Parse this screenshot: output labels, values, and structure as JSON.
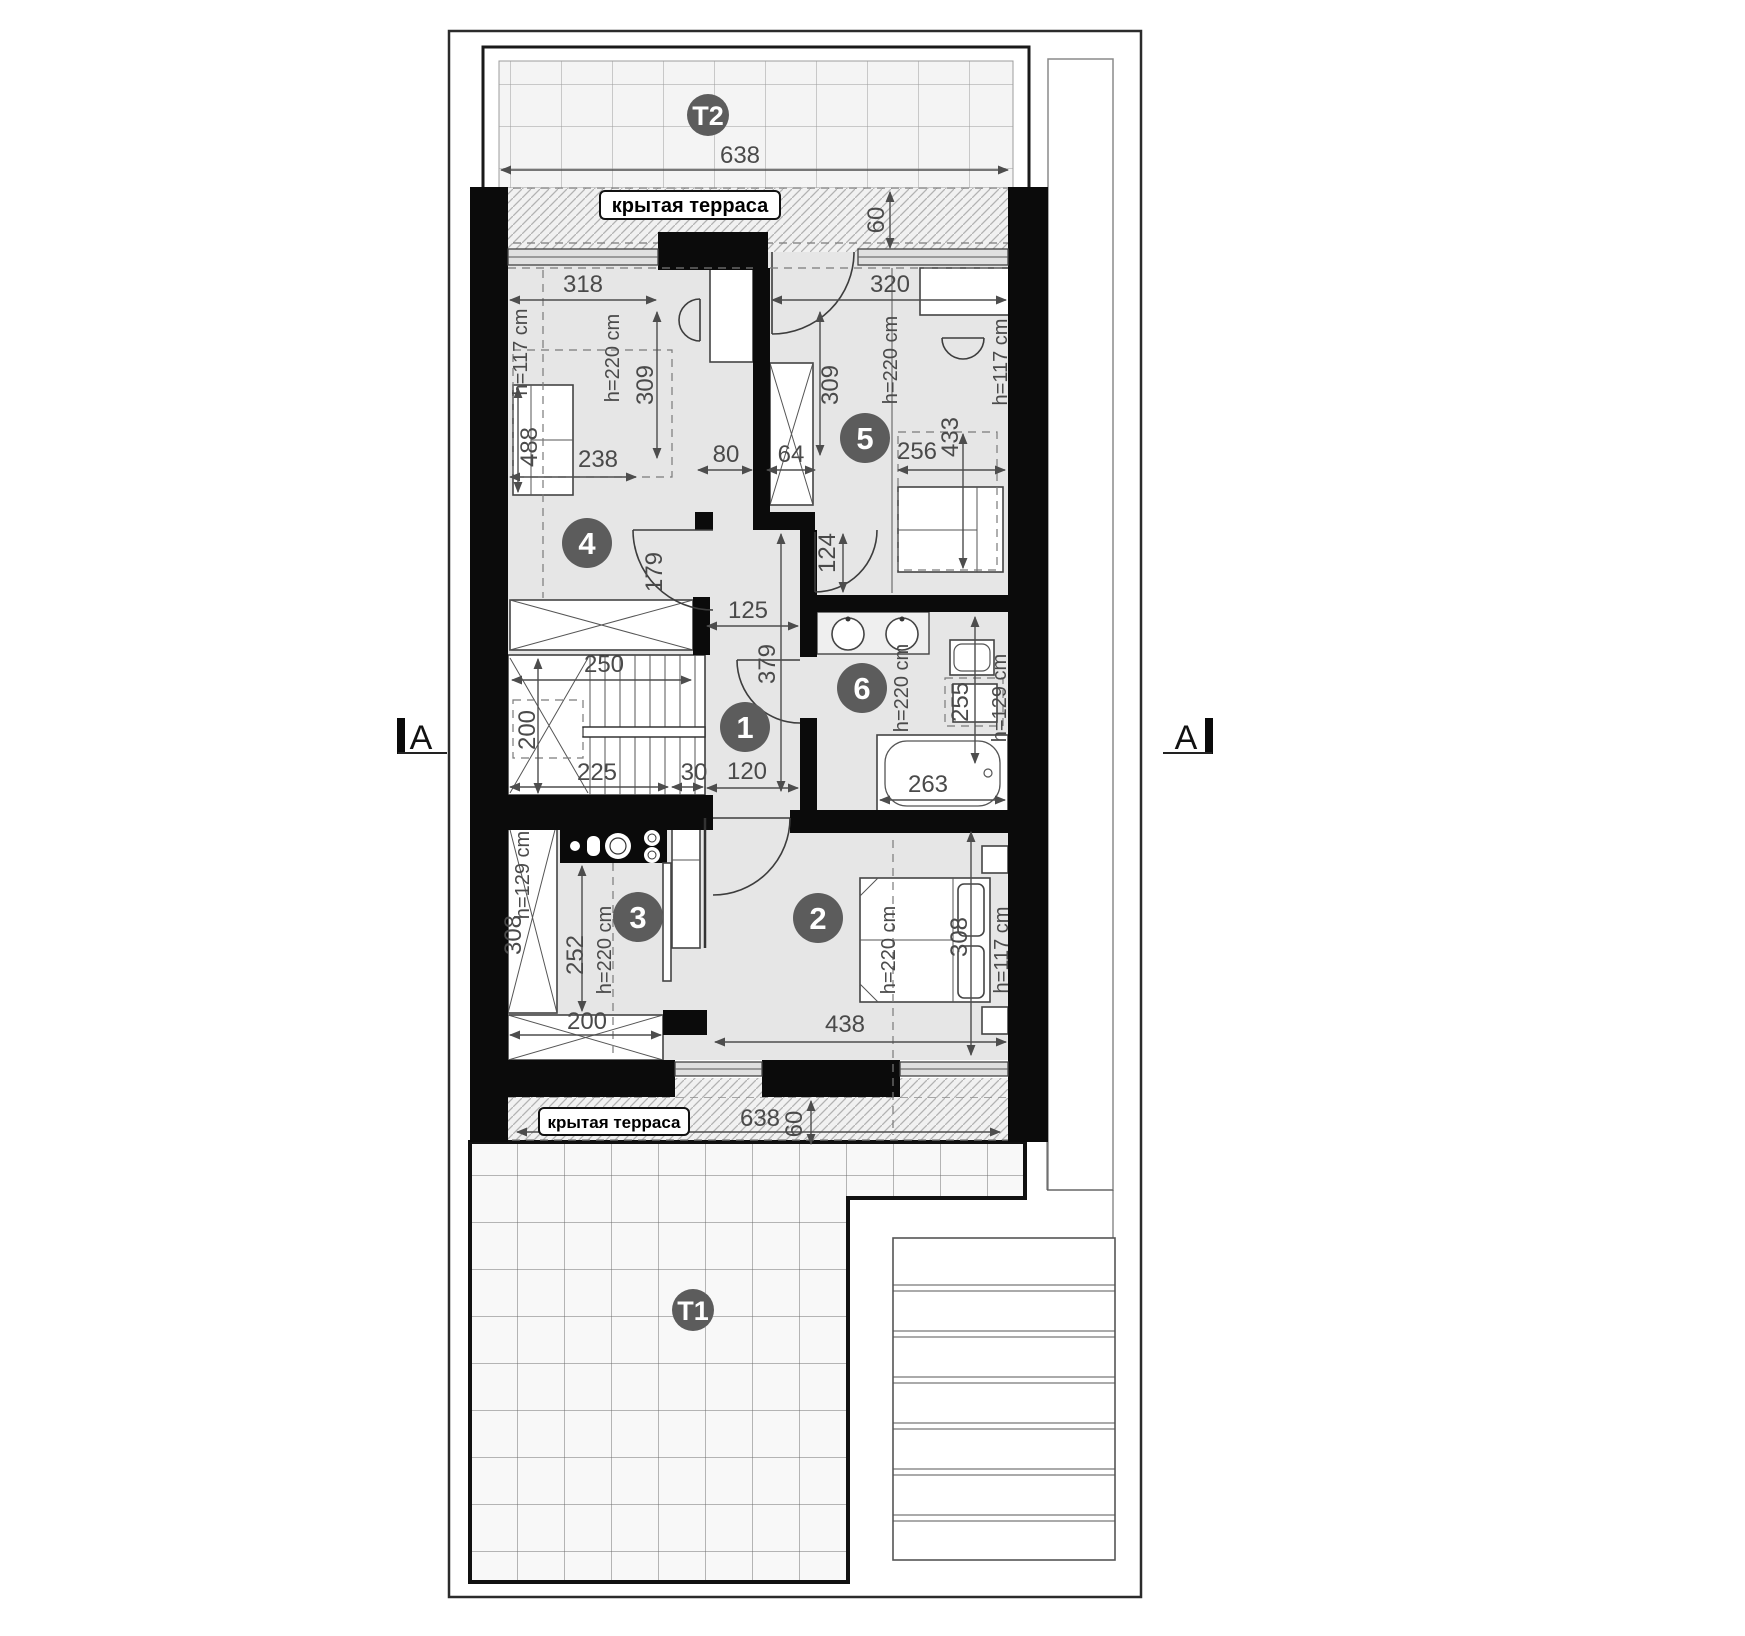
{
  "section": {
    "left": "A",
    "right": "A"
  },
  "terrace_top": {
    "badge": "T2",
    "label": "крытая терраса",
    "width": "638",
    "depth": "60"
  },
  "terrace_bottom": {
    "badge": "T1",
    "label": "крытая терраса",
    "width": "638",
    "depth": "60"
  },
  "rooms": {
    "r1": {
      "number": "1",
      "dim_width_top": "125",
      "dim_depth": "379",
      "dim_width_bottom": "120"
    },
    "r2": {
      "number": "2",
      "dim_width": "438",
      "dim_length": "308",
      "note_h220": "h=220 cm",
      "note_h117": "h=117 cm"
    },
    "r3": {
      "number": "3",
      "dim_width": "200",
      "dim_depth": "252",
      "dim_cabinet": "308",
      "note_h220": "h=220 cm",
      "note_h129": "h=129 cm"
    },
    "r4": {
      "number": "4",
      "dim_width_top": "318",
      "dim_depth": "309",
      "dim_sofa": "488",
      "dim_zone": "238",
      "dim_door": "179",
      "dim_niche": "80",
      "dim_shaft": "64",
      "note_h220": "h=220 cm",
      "note_h117": "h=117 cm"
    },
    "r5": {
      "number": "5",
      "dim_width_top": "320",
      "dim_depth": "309",
      "dim_zone_w": "256",
      "dim_zone_d": "433",
      "dim_door": "124",
      "note_h220": "h=220 cm",
      "note_h117": "h=117 cm"
    },
    "r6": {
      "number": "6",
      "dim_tub": "263",
      "dim_side": "255",
      "note_h220": "h=220 cm",
      "note_h129": "h=129 cm"
    },
    "stairs": {
      "dim_top": "250",
      "dim_left": "200",
      "dim_bottom": "225",
      "dim_right": "30"
    }
  }
}
